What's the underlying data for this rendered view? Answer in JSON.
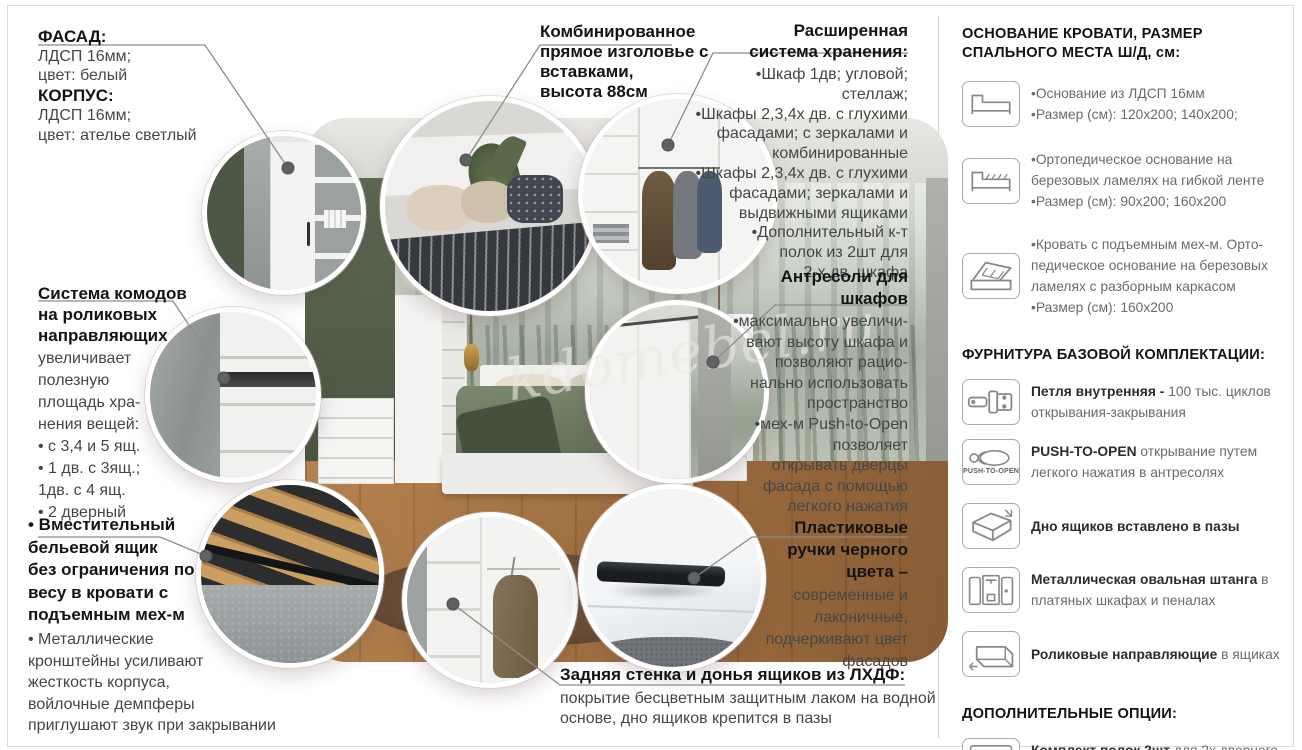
{
  "watermark": "kdomebel.ru",
  "colors": {
    "heading": "#141414",
    "body_text": "#464646",
    "panel_text": "#6b6b6b",
    "callout_line": "#8c8c8c",
    "circle_ring": "#ffffff"
  },
  "blocks": {
    "facade": {
      "lines": [
        "ФАСАД:",
        "ЛДСП 16мм;",
        "цвет: белый",
        "КОРПУС:",
        "ЛДСП 16мм;",
        "цвет: ателье светлый"
      ]
    },
    "headboard": {
      "lines": [
        "Комбинированное",
        "прямое изголовье с",
        "вставками,",
        "высота 88см"
      ]
    },
    "storage": {
      "title_lines": [
        "Расширенная",
        "система хранения:"
      ],
      "lines": [
        "•Шкаф 1дв; угловой; стеллаж;",
        "•Шкафы 2,3,4х дв. с глухими",
        "фасадами; с зеркалами и",
        "комбинированные",
        "•Шкафы 2,3,4х дв. с глухими",
        "фасадами; зеркалами и",
        "выдвижными ящиками",
        "•Дополнительный к-т",
        "полок из 2шт для",
        "2-х дв. шкафа"
      ]
    },
    "commode": {
      "title_lines": [
        "Система комодов",
        "на роликовых",
        "направляющих"
      ],
      "lines": [
        "увеличивает",
        "полезную",
        "площадь хра-",
        "нения вещей:",
        "• с 3,4 и 5 ящ.",
        "• 1 дв. с 3ящ.;",
        "1дв. с 4 ящ.",
        "• 2 дверный"
      ]
    },
    "mezzanine": {
      "title_lines": [
        "Антресоли для",
        "шкафов"
      ],
      "lines": [
        "•максимально увеличи-",
        "вают высоту шкафа и",
        "позволяют рацио-",
        "нально использовать",
        "пространство",
        "•мех-м Push-to-Open",
        "позволяет",
        "открывать дверцы",
        "фасада с помощью",
        "легкого нажатия"
      ]
    },
    "linen": {
      "title_lines": [
        "• Вместительный",
        "бельевой ящик",
        "без ограничения по",
        "весу в кровати с",
        "подъемным мех-м"
      ],
      "lines": [
        "• Металлические",
        "кронштейны усиливают",
        "жесткость корпуса,",
        "войлочные демпферы",
        "приглушают звук при закрывании"
      ]
    },
    "handles": {
      "title_lines": [
        "Пластиковые",
        "ручки черного",
        "цвета –"
      ],
      "lines": [
        "современные и",
        "лаконичные,",
        "подчеркивают цвет",
        "фасадов"
      ]
    },
    "backwall": {
      "title": "Задняя стенка и донья ящиков из ЛХДФ:",
      "lines": [
        "покрытие бесцветным защитным лаком на водной",
        "основе, дно ящиков крепится в пазы"
      ]
    }
  },
  "panel": {
    "bed_title_lines": [
      "ОСНОВАНИЕ КРОВАТИ, РАЗМЕР",
      "СПАЛЬНОГО МЕСТА Ш/Д, см:"
    ],
    "bed_items": [
      {
        "icon": "bed-base-icon",
        "lines": [
          "•Основание из ЛДСП 16мм",
          "•Размер (см): 120х200; 140х200;"
        ]
      },
      {
        "icon": "bed-slats-icon",
        "lines": [
          "•Ортопедическое основание на",
          "березовых ламелях на гибкой ленте",
          "•Размер (см): 90х200; 160х200"
        ]
      },
      {
        "icon": "bed-lift-icon",
        "lines": [
          "•Кровать с подъемным мех-м. Орто-",
          "педическое основание на березовых",
          "ламелях с разборным каркасом",
          "•Размер (см): 160х200"
        ]
      }
    ],
    "hardware_title": "ФУРНИТУРА БАЗОВОЙ КОМПЛЕКТАЦИИ:",
    "hardware_items": [
      {
        "icon": "hinge-icon",
        "bold": "Петля внутренняя - ",
        "rest": "100 тыс. циклов открывания-закрывания"
      },
      {
        "icon": "push-to-open-icon",
        "icon_label": "PUSH-TO-OPEN",
        "bold": "PUSH-TO-OPEN",
        "rest": " открывание путем легкого нажатия в антресолях"
      },
      {
        "icon": "drawer-bottom-icon",
        "bold": "Дно ящиков вставлено в пазы",
        "rest": ""
      },
      {
        "icon": "wardrobe-rail-icon",
        "bold": "Металлическая овальная штанга",
        "rest": " в платяных шкафах и пеналах"
      },
      {
        "icon": "drawer-roller-icon",
        "bold": "Роликовые направляющие",
        "rest": " в ящиках"
      }
    ],
    "options_title": "ДОПОЛНИТЕЛЬНЫЕ ОПЦИИ:",
    "options_items": [
      {
        "icon": "shelves-icon",
        "bold": "Комплект полок 2шт",
        "rest": " для 2х дверного шкафа"
      }
    ]
  }
}
